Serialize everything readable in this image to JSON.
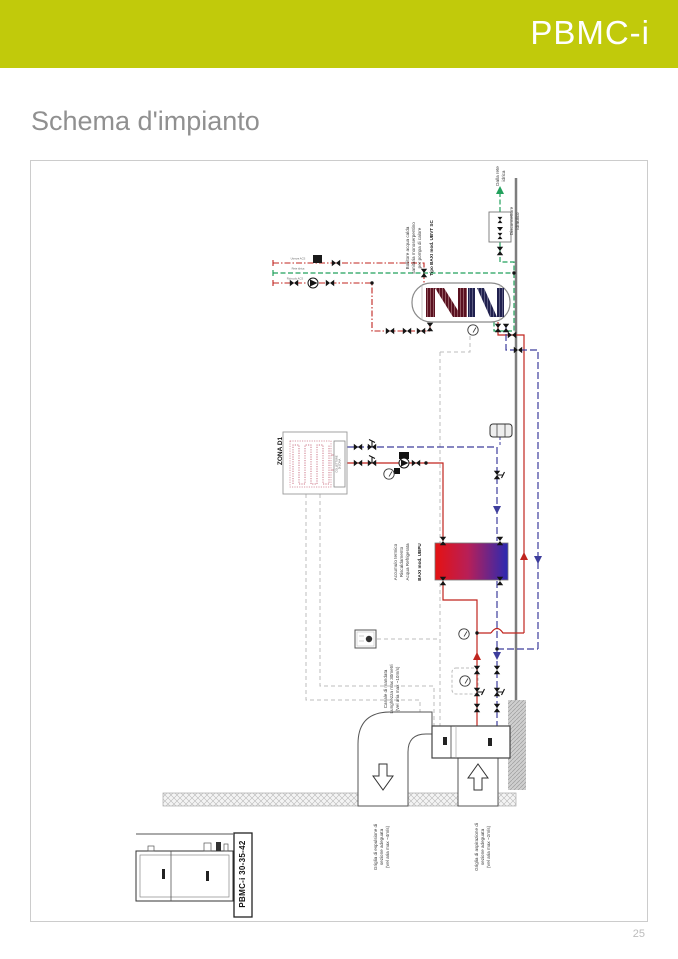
{
  "header": {
    "product_name": "PBMC-i",
    "bar_color": "#c1ca0b"
  },
  "page": {
    "title": "Schema d'impianto",
    "number": "25"
  },
  "diagram": {
    "labels": {
      "water_mains": "Dalla rete\nidrica",
      "disconnector": "Disconnettore\nidraulico",
      "dhw_cylinder": "Bollitore acqua calda\nsanitaria monoserpentino\nper pompa di calore",
      "dhw_cylinder_model": "Tipo BAXI mod. UBVT SC",
      "zone": "ZONA D1",
      "zone_manifold": "COLLETTORE\nDI ZONA",
      "buffer_tank": "Accumulo termico\nRiscaldamento\nAcqua Refrigerata",
      "buffer_tank_model": "BAXI mod. UBPU",
      "supply_duct": "Canale di mandata\nLunghezza max 30metri\n(Vel aria max ~10m/s)",
      "exhaust_grille": "Griglia di espulsione di\nsezione adeguata\n(Vel aria max ~4m/s)",
      "intake_grille": "Griglia di aspirazione di\nsezione adeguata\n(Vel aria max ~2m/s)",
      "unit_model": "PBMC-i 30-35-42",
      "stub_dhw_users": "Utenze ACS",
      "stub_mains": "Rete idrica",
      "stub_recirculation": "Ricircolo ACS"
    },
    "legend_colors": {
      "heating_flow": "#c0251f",
      "chilled_return": "#3d3d9c",
      "sanitary_water": "#22a05c",
      "control_wiring": "#bcbcbc"
    }
  }
}
